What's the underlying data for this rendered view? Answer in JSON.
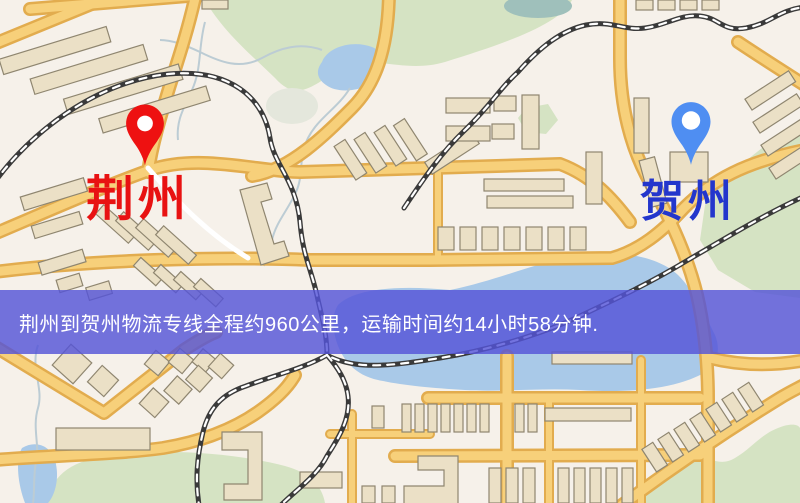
{
  "map": {
    "origin": {
      "label": "荆州",
      "pin_color": "#ee1111",
      "label_color": "#e81212"
    },
    "destination": {
      "label": "贺州",
      "pin_color": "#4f8ef2",
      "label_color": "#2336cc"
    },
    "banner": {
      "text": "荆州到贺州物流专线全程约960公里，运输时间约14小时58分钟.",
      "distance_text": "约960公里",
      "duration_text": "约14小时58分钟",
      "background_color": "#5454d8",
      "text_color": "#ffffff"
    },
    "palette": {
      "land": "#f6f1ea",
      "park": "#d5e3c3",
      "water": "#a9c9e8",
      "road_fill": "#f7d07a",
      "road_casing": "#e2ac4e",
      "building": "#ebe0c6",
      "building_outline": "#8f8670",
      "railway": "#3a3a3a"
    }
  }
}
